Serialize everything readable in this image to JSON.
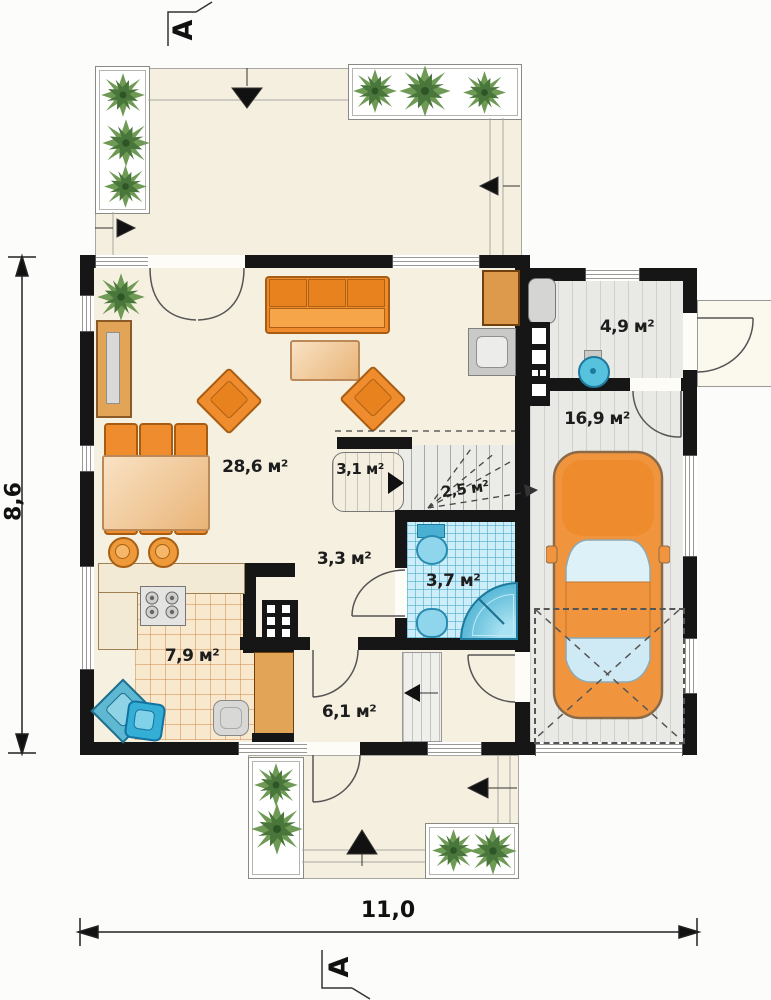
{
  "sections": {
    "top": "A",
    "bottom": "A"
  },
  "dimensions": {
    "height": "8,6",
    "width": "11,0"
  },
  "rooms": {
    "living_room": {
      "area": "28,6 м²"
    },
    "pantry": {
      "area": "3,1 м²"
    },
    "stairs": {
      "area": "2,5 м²"
    },
    "utility": {
      "area": "4,9 м²"
    },
    "garage": {
      "area": "16,9 м²"
    },
    "hall": {
      "area": "3,3 м²"
    },
    "bathroom": {
      "area": "3,7 м²"
    },
    "kitchen": {
      "area": "7,9 м²"
    },
    "entry_hall": {
      "area": "6,1 м²"
    }
  },
  "colors": {
    "wall": "#161616",
    "floor": "#f6f0e0",
    "furniture_accent": "#ef8d2e",
    "water_fixture": "#45b3d6",
    "bath_tile": "#cdeef8",
    "garage_floor": "#e9e9e6",
    "plan_line": "#8a8a85"
  },
  "icons": {
    "plant": "green-burst",
    "car": "car-top-view",
    "direction_arrow": "black-triangle"
  }
}
